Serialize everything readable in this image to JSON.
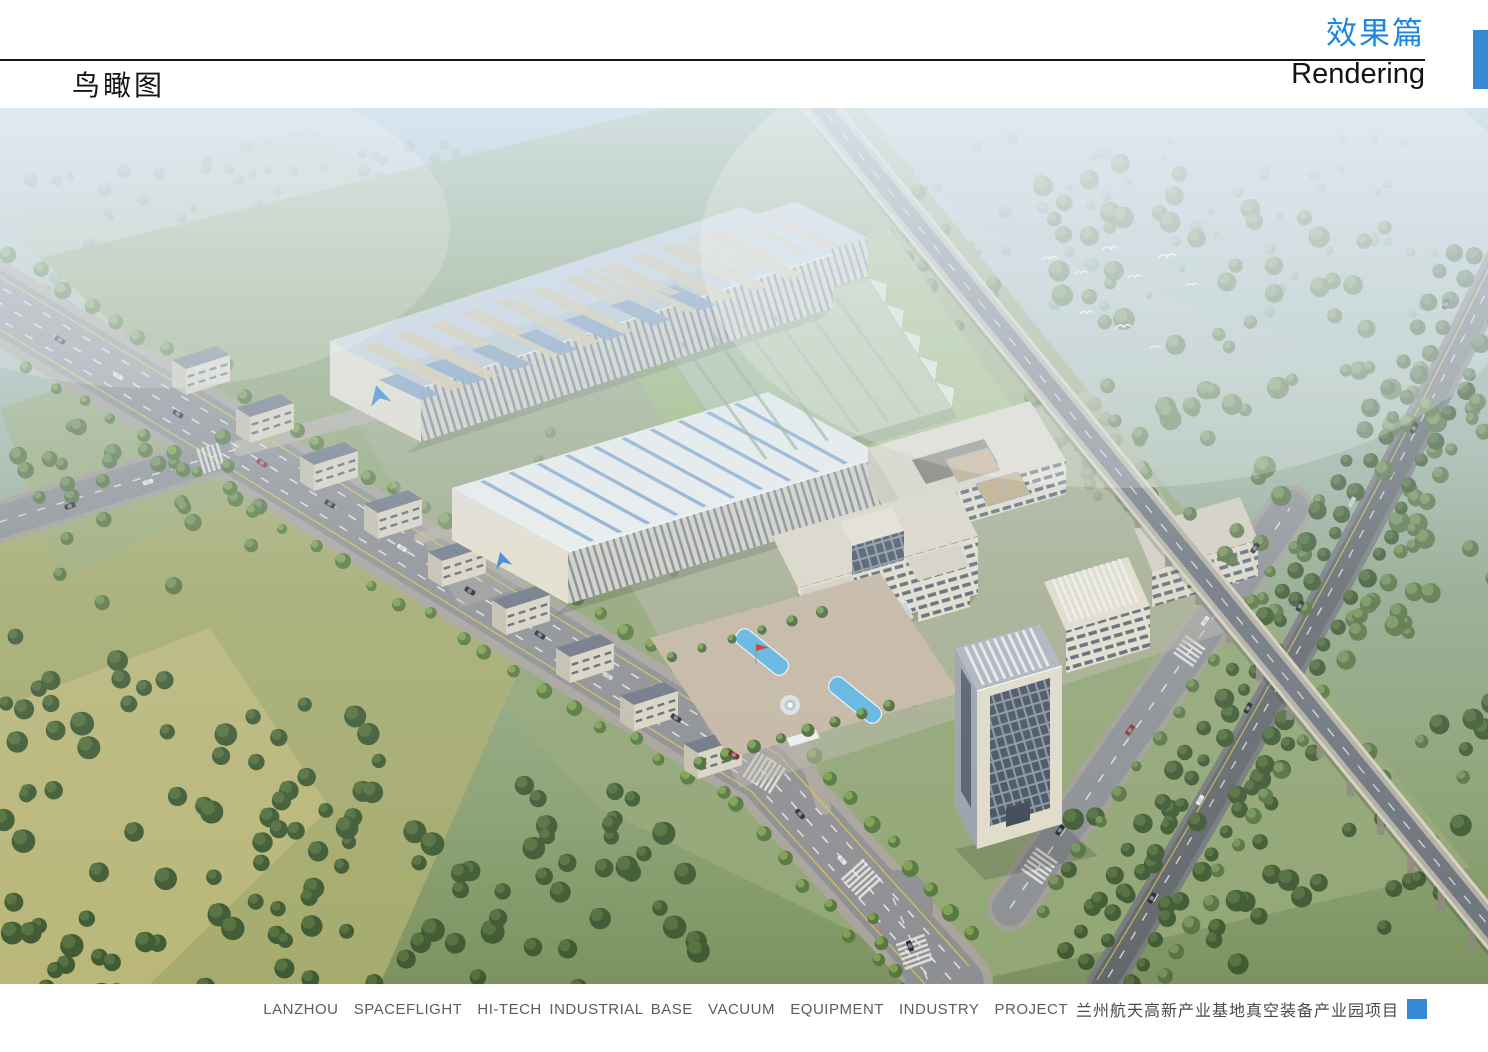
{
  "theme": {
    "accent": "#1d86e0",
    "accent_block": "#3488d4",
    "page_bg": "#ffffff",
    "rule_color": "#161616"
  },
  "header": {
    "left_title": "鸟瞰图",
    "right_title": "效果篇",
    "right_subtitle": "Rendering"
  },
  "footer": {
    "caption_en": "LANZHOU  SPACEFLIGHT  HI-TECH INDUSTRIAL BASE  VACUUM  EQUIPMENT  INDUSTRY  PROJECT",
    "caption_cn": "兰州航天高新产业基地真空装备产业园项目"
  },
  "scene": {
    "palette": {
      "tree_dark": "#3f5a33",
      "tree_mid": "#56713f",
      "tree_light": "#7fa050",
      "tree_haze": "#7e9a8c",
      "tree_haze_light": "#98b1a0",
      "water": "#5fb5e2",
      "flag": "#c8372b",
      "asphalt": "#8e8f92",
      "viaduct_deck": "#b4afa3",
      "factory_roof": "#cbd4dd",
      "facade_cream": "#ddd5c3",
      "greenhouse": "#aec49f"
    }
  }
}
